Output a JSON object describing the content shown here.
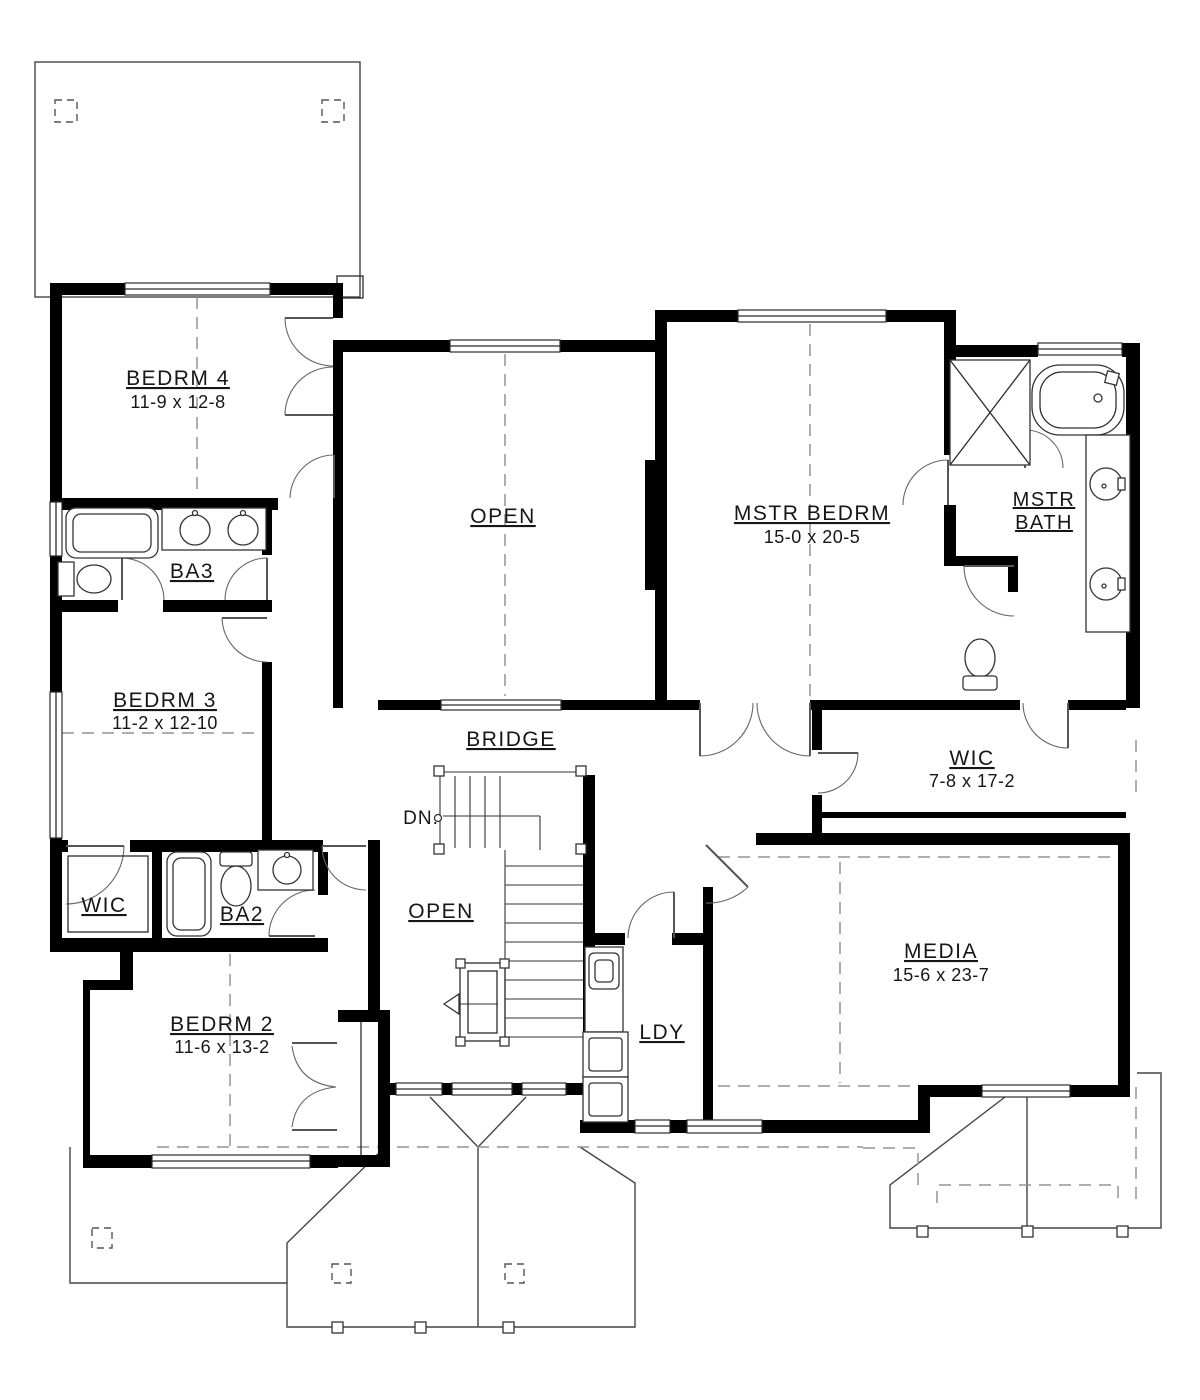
{
  "drawing": {
    "type": "second-floor-plan",
    "colors": {
      "wall": "#000000",
      "line": "#2b2b2b",
      "dashed": "#949494",
      "background": "#ffffff"
    }
  },
  "rooms": {
    "bedrm4": {
      "name": "BEDRM 4",
      "dims": "11-9 x 12-8"
    },
    "bedrm3": {
      "name": "BEDRM 3",
      "dims": "11-2 x 12-10"
    },
    "bedrm2": {
      "name": "BEDRM 2",
      "dims": "11-6 x 13-2"
    },
    "mstr_bedrm": {
      "name": "MSTR BEDRM",
      "dims": "15-0 x 20-5"
    },
    "mstr_bath": {
      "line1": "MSTR",
      "line2": "BATH"
    },
    "media": {
      "name": "MEDIA",
      "dims": "15-6 x 23-7"
    },
    "wic_right": {
      "name": "WIC",
      "dims": "7-8 x 17-2"
    },
    "wic_left": {
      "name": "WIC"
    },
    "ba3": {
      "name": "BA3"
    },
    "ba2": {
      "name": "BA2"
    },
    "ldy": {
      "name": "LDY"
    },
    "open_upper": {
      "name": "OPEN"
    },
    "open_lower": {
      "name": "OPEN"
    },
    "bridge": {
      "name": "BRIDGE"
    }
  },
  "stairs": {
    "down_label": "DN."
  }
}
